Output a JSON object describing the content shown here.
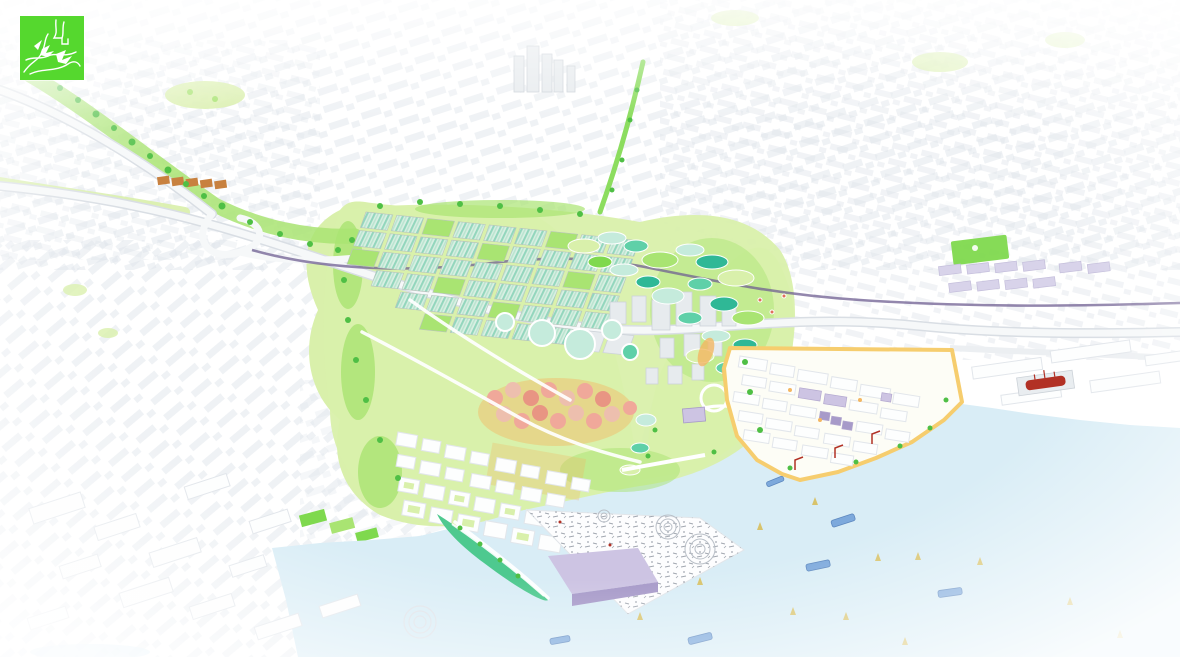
{
  "scene": {
    "kind": "aerial-masterplan-rendering",
    "description": "Bird's-eye illustrated masterplan: white existing city fabric around a green redevelopment valley reaching a pale blue bay",
    "visible_text": ""
  },
  "logo": {
    "name": "studio-logo",
    "alt": "Green square logo with white abstract plan line-work",
    "background": "#55d82e",
    "line_color": "#ffffff"
  },
  "palette": {
    "logoGreen": "#55d82e",
    "cityShadow": "#dfe4ea",
    "greyLine": "#e2e6eb",
    "water": "#d9edf6",
    "parkLight": "#d9f0ab",
    "parkMid": "#a9e472",
    "parkBright": "#7fd94e",
    "greenDark": "#4fbf45",
    "teal": "#5fd0a8",
    "tealDeep": "#2fb896",
    "aquaPale": "#c5ebdc",
    "orchardPink": "#f0a89a",
    "sandOrange": "#f3b763",
    "quayYellow": "#f6cd6e",
    "lavender": "#cdc4e3",
    "purpleMid": "#a79ac9",
    "railPurple": "#6f5f91",
    "shipRed": "#b23125",
    "boatBlue": "#7da9dc",
    "sailYellow": "#d8c36b",
    "stationBrown": "#c8813f",
    "doodleGrey": "#8a919c"
  },
  "regions": {
    "city": "Existing city fabric (white 3D massing)",
    "interchange": "Highway interchange with green corridor",
    "greenhouses": "Gridded greenhouse district with striped eco roofs",
    "wetland": "Wetland park with terraced ponds",
    "orchard": "Pink blossom orchard grove",
    "neighborhood": "New low-rise neighborhood blocks",
    "towers": "Mid-rise blocks on the park edge",
    "river": "Restored tidal creek channel",
    "port": "Port peninsula with warehouses and yellow quays",
    "shipyard": "Shipyard piers with red ship in dry dock",
    "pier": "Triangular festival pier with sketched event crowd",
    "bay": "Bay water with barges and sailboat buoys",
    "peninsula": "Green headland with shore path",
    "boulevard": "Green boulevard link to downtown",
    "downtown": "Downtown tower cluster",
    "parks": "Neighborhood parks and sports fields"
  }
}
